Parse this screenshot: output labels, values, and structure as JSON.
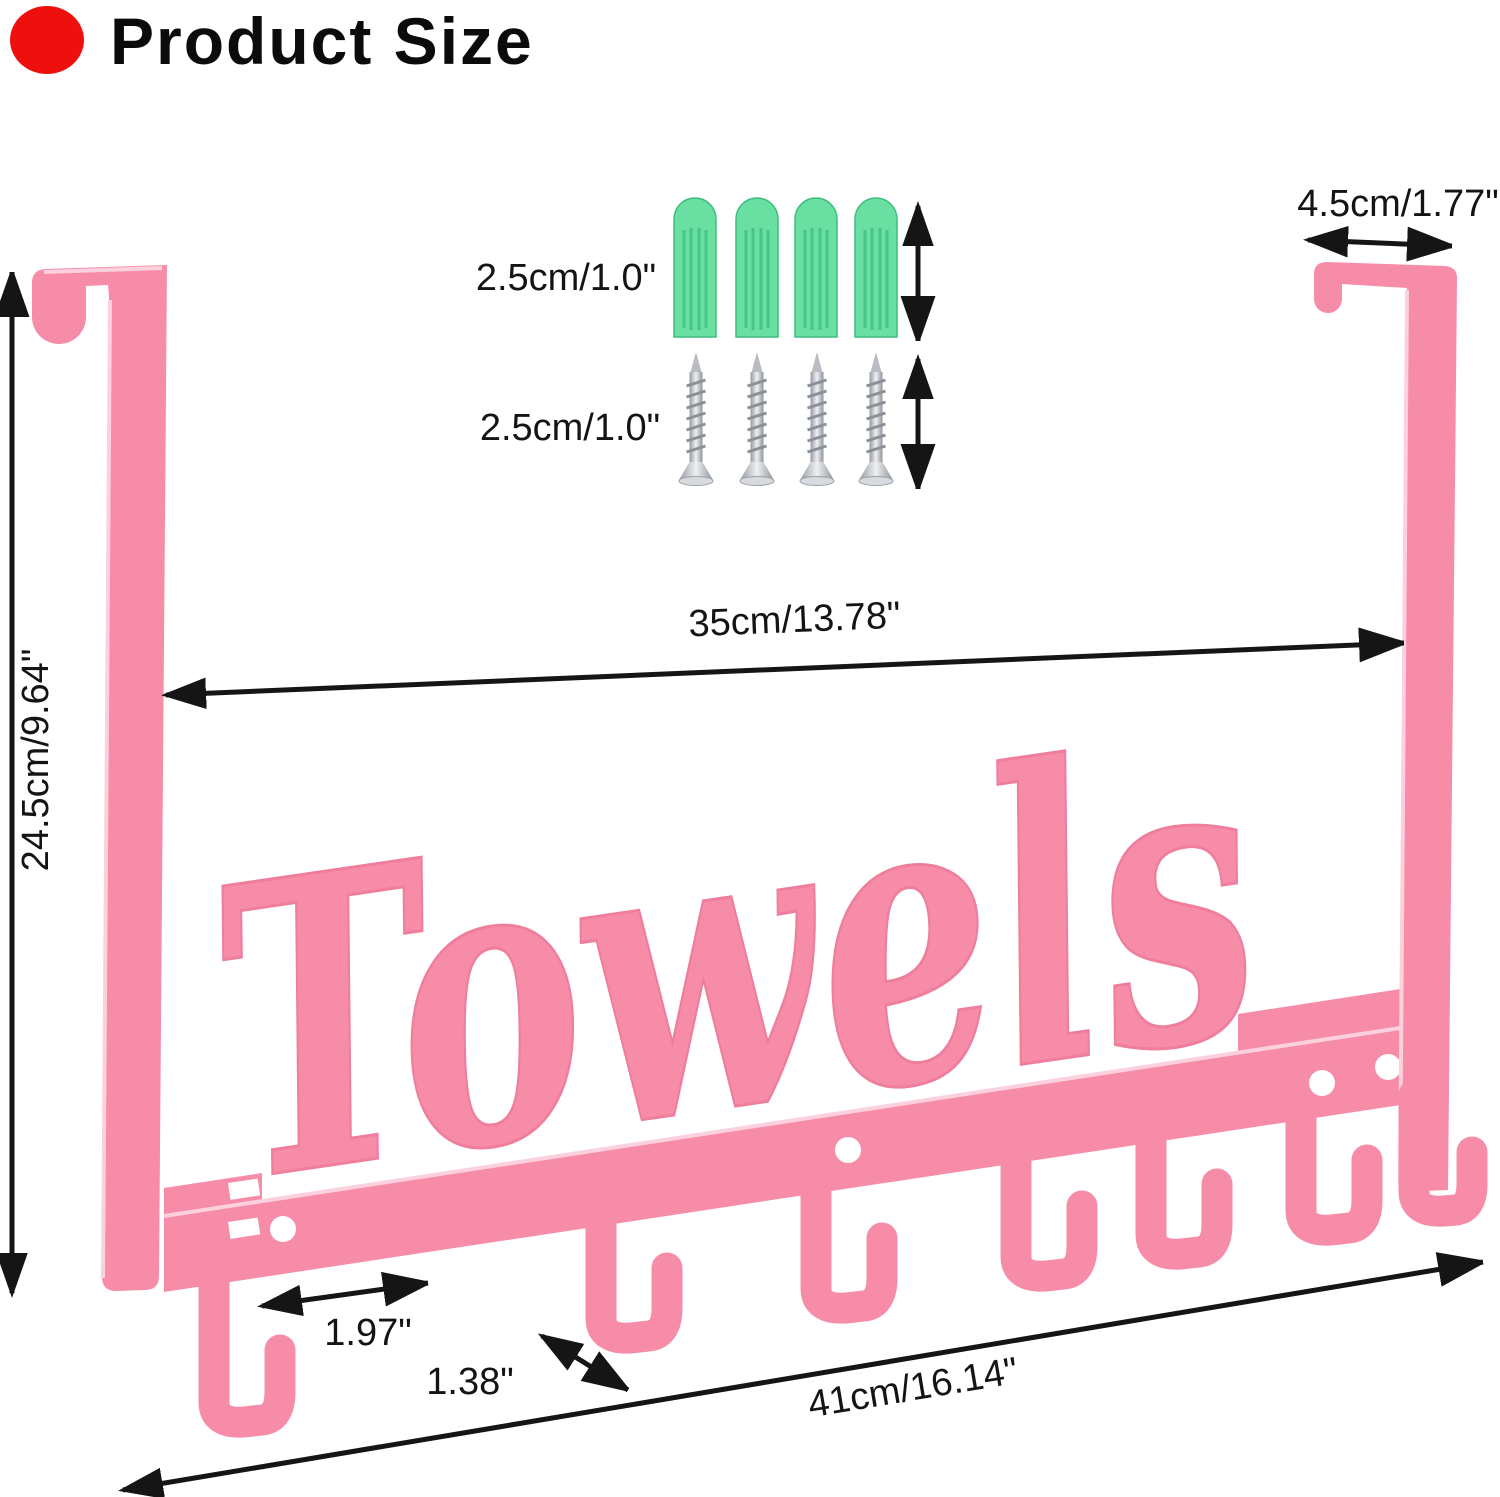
{
  "title": {
    "text": "Product Size",
    "bullet_color": "#ee0f0f"
  },
  "product": {
    "script_label": "Towels",
    "hook_count": 7,
    "color_pink": "#f78ca8",
    "color_pink_light": "#fcd0dc"
  },
  "hardware": {
    "anchors": {
      "count": 4,
      "color": "#69dfa2"
    },
    "screws": {
      "count": 4,
      "color": "#c9cdd2"
    }
  },
  "dimensions": {
    "bracket_depth": "4.5cm/1.77\"",
    "anchor_length": "2.5cm/1.0\"",
    "screw_length": "2.5cm/1.0\"",
    "inner_width": "35cm/13.78\"",
    "height": "24.5cm/9.64\"",
    "hook_spacing": "1.97\"",
    "hook_width": "1.38\"",
    "total_width": "41cm/16.14\""
  },
  "colors": {
    "annotation": "#141414",
    "background": "#ffffff"
  }
}
